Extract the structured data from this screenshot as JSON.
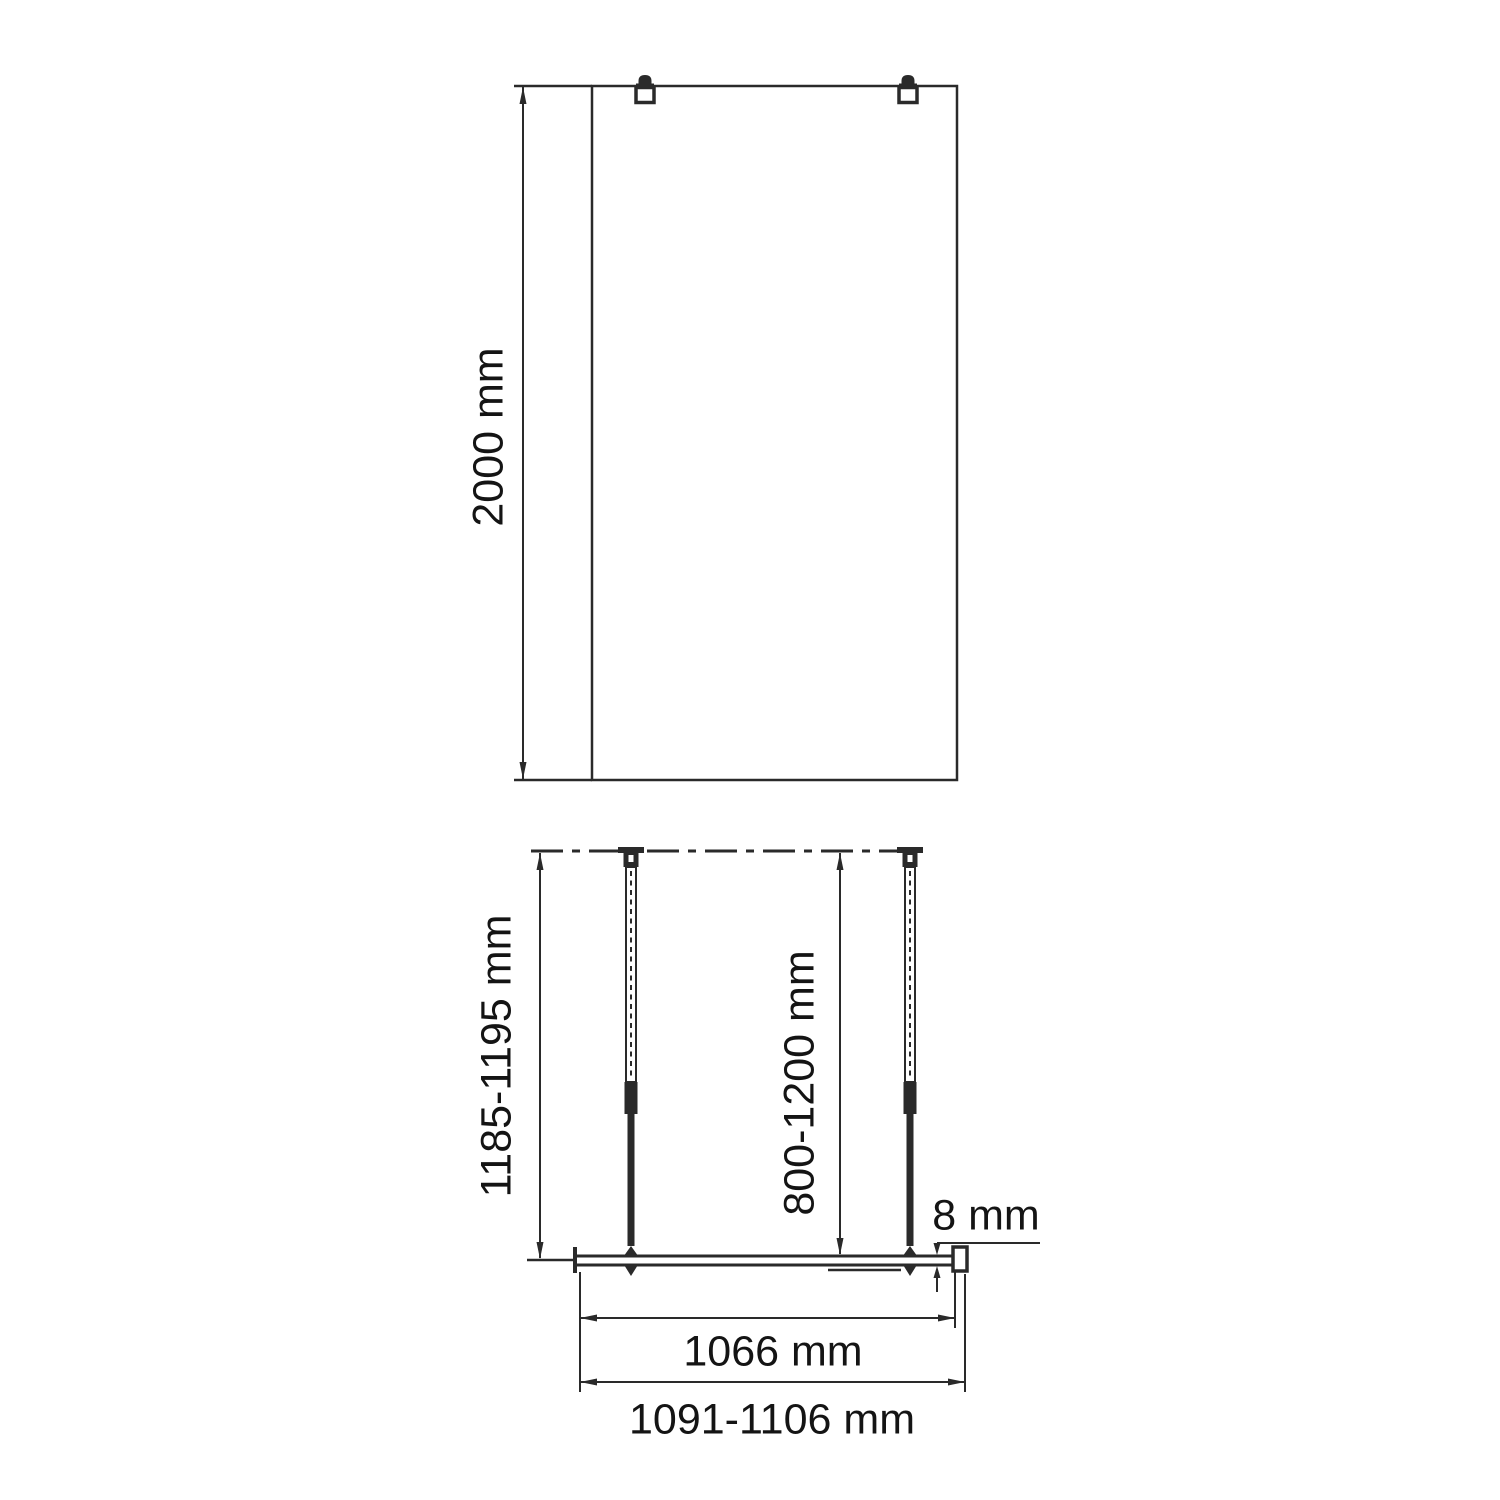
{
  "colors": {
    "line": "#2a2a2a",
    "text": "#141414",
    "background": "#ffffff"
  },
  "front_view": {
    "height_label": "2000 mm"
  },
  "plan_view": {
    "depth_label": "1185-1195 mm",
    "bar_length_label": "800-1200 mm",
    "glass_thickness_label": "8 mm",
    "glass_width_label": "1066 mm",
    "overall_width_label": "1091-1106 mm"
  }
}
